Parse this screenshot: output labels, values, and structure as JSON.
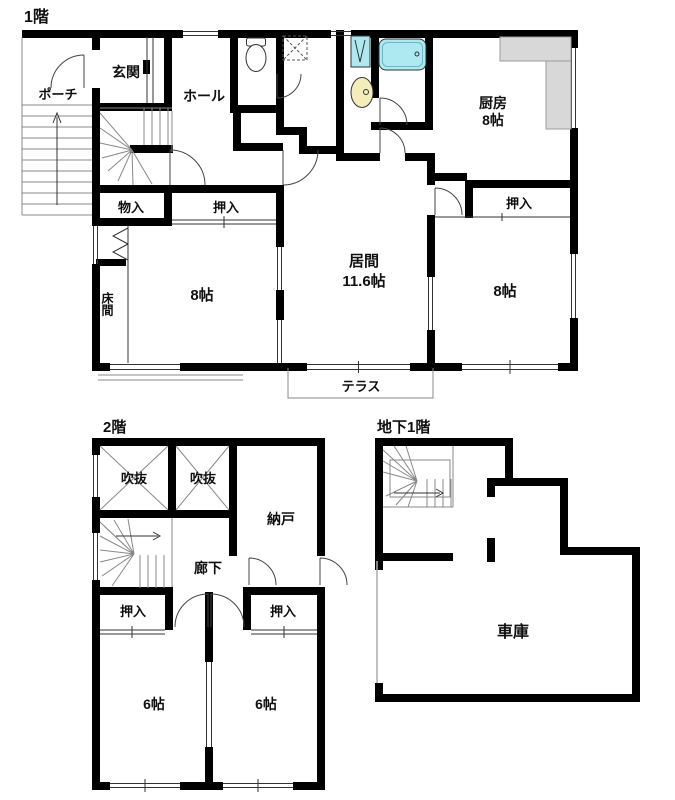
{
  "palette": {
    "wall": "#000000",
    "thin_line": "#333333",
    "tub": "#aee9f2",
    "washer_pan": "#aee9f2",
    "basin": "#f2edba",
    "counter": "#d8d8d8",
    "counter_border": "#9a9a9a",
    "background": "#ffffff",
    "text": "#101010"
  },
  "floors": {
    "f1": {
      "title": "1階",
      "rooms": {
        "porch": "ポーチ",
        "genkan": "玄関",
        "hall": "ホール",
        "kitchen_name": "厨房",
        "kitchen_size": "8帖",
        "oshiire_kitchen": "押入",
        "monoire": "物入",
        "oshiire_left": "押入",
        "tokonoma": "床間",
        "washitsu_left_size": "8帖",
        "living_name": "居間",
        "living_size": "11.6帖",
        "washitsu_right_size": "8帖",
        "terrace": "テラス"
      }
    },
    "f2": {
      "title": "2階",
      "rooms": {
        "void_left": "吹抜",
        "void_right": "吹抜",
        "storeroom": "納戸",
        "corridor": "廊下",
        "oshiire_left": "押入",
        "oshiire_right": "押入",
        "room_left_size": "6帖",
        "room_right_size": "6帖"
      }
    },
    "b1": {
      "title": "地下1階",
      "rooms": {
        "garage": "車庫"
      }
    }
  }
}
